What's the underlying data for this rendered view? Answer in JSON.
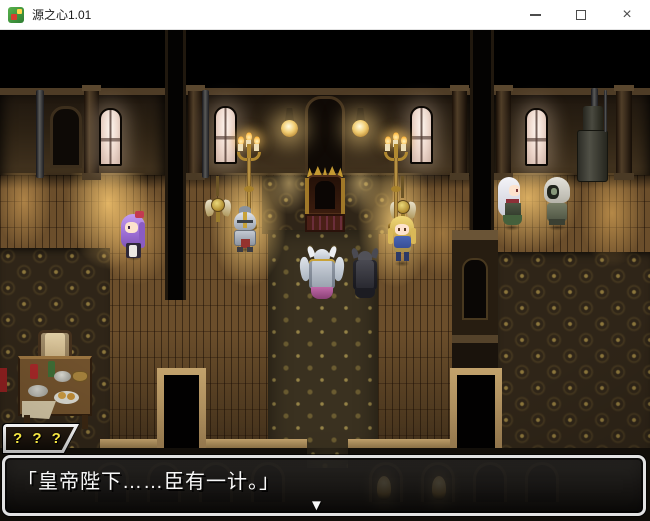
{
  "titlebar": {
    "title": "源之心1.01",
    "close_glyph": "×"
  },
  "dialogue": {
    "speaker_name": "? ? ?",
    "text": "「皇帝陛下……臣有一计。」",
    "continue_glyph": "▼"
  },
  "scene": {
    "characters": [
      {
        "name": "purple-haired-attendant"
      },
      {
        "name": "silver-knight"
      },
      {
        "name": "white-winged-armor-general"
      },
      {
        "name": "black-armor-general"
      },
      {
        "name": "blonde-knight-blue-armor"
      },
      {
        "name": "white-haired-noble"
      },
      {
        "name": "hooded-figure"
      }
    ],
    "props": [
      "throne",
      "floor-candelabra-left",
      "floor-candelabra-right",
      "wall-lamp-left",
      "wall-lamp-right",
      "wall-crest-left",
      "wall-crest-right",
      "arched-windows",
      "furnace",
      "dining-table",
      "chair",
      "doorway-left",
      "doorway-right",
      "shrine-alcove"
    ],
    "colors": {
      "lamp_glow": "#ffd886",
      "wood_lit": "#c08a44",
      "wood_dark": "#5a4326",
      "upper_wall": "#32281a",
      "carpet": "#3a3222",
      "window_glow": "#efe2da",
      "dialog_border": "#e2e2e2",
      "name_text": "#f5e642",
      "tan_trim": "#b6945f"
    }
  }
}
